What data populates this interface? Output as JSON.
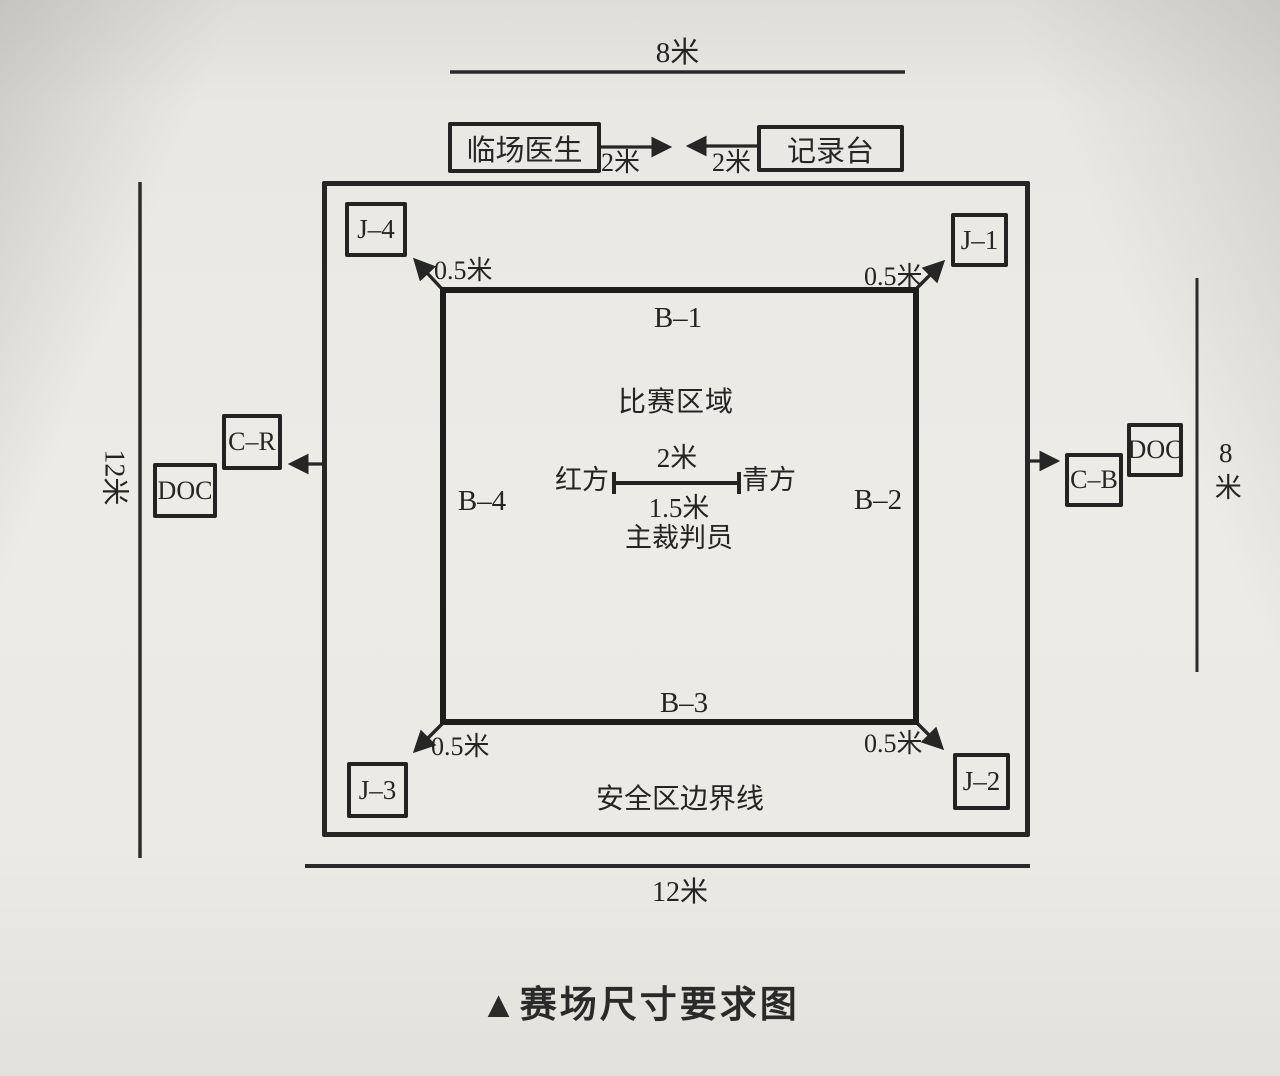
{
  "caption": "▲赛场尺寸要求图",
  "colors": {
    "ink": "#2a2a2a",
    "paper": "#eae8e3"
  },
  "top_section": {
    "width_label": "8米",
    "doctor_box": "临场医生",
    "recorder_box": "记录台",
    "gap_left_label": "2米",
    "gap_right_label": "2米"
  },
  "safety_area": {
    "boundary_label": "安全区边界线",
    "bottom_width_label": "12米",
    "left_height_label": "12米",
    "right_height_label": "8米"
  },
  "judge_boxes": {
    "j1": "J–1",
    "j2": "J–2",
    "j3": "J–3",
    "j4": "J–4"
  },
  "corner_offset_labels": {
    "top_left": "0.5米",
    "top_right": "0.5米",
    "bottom_left": "0.5米",
    "bottom_right": "0.5米"
  },
  "competition_area": {
    "label": "比赛区域",
    "b1": "B–1",
    "b2": "B–2",
    "b3": "B–3",
    "b4": "B–4",
    "center_length_label": "2米",
    "red_side_label": "红方",
    "blue_side_label": "青方",
    "referee_distance_label": "1.5米",
    "referee_label": "主裁判员"
  },
  "officials": {
    "coach_red": "C–R",
    "coach_blue": "C–B",
    "doctor_left": "DOC",
    "doctor_right": "DOC"
  }
}
